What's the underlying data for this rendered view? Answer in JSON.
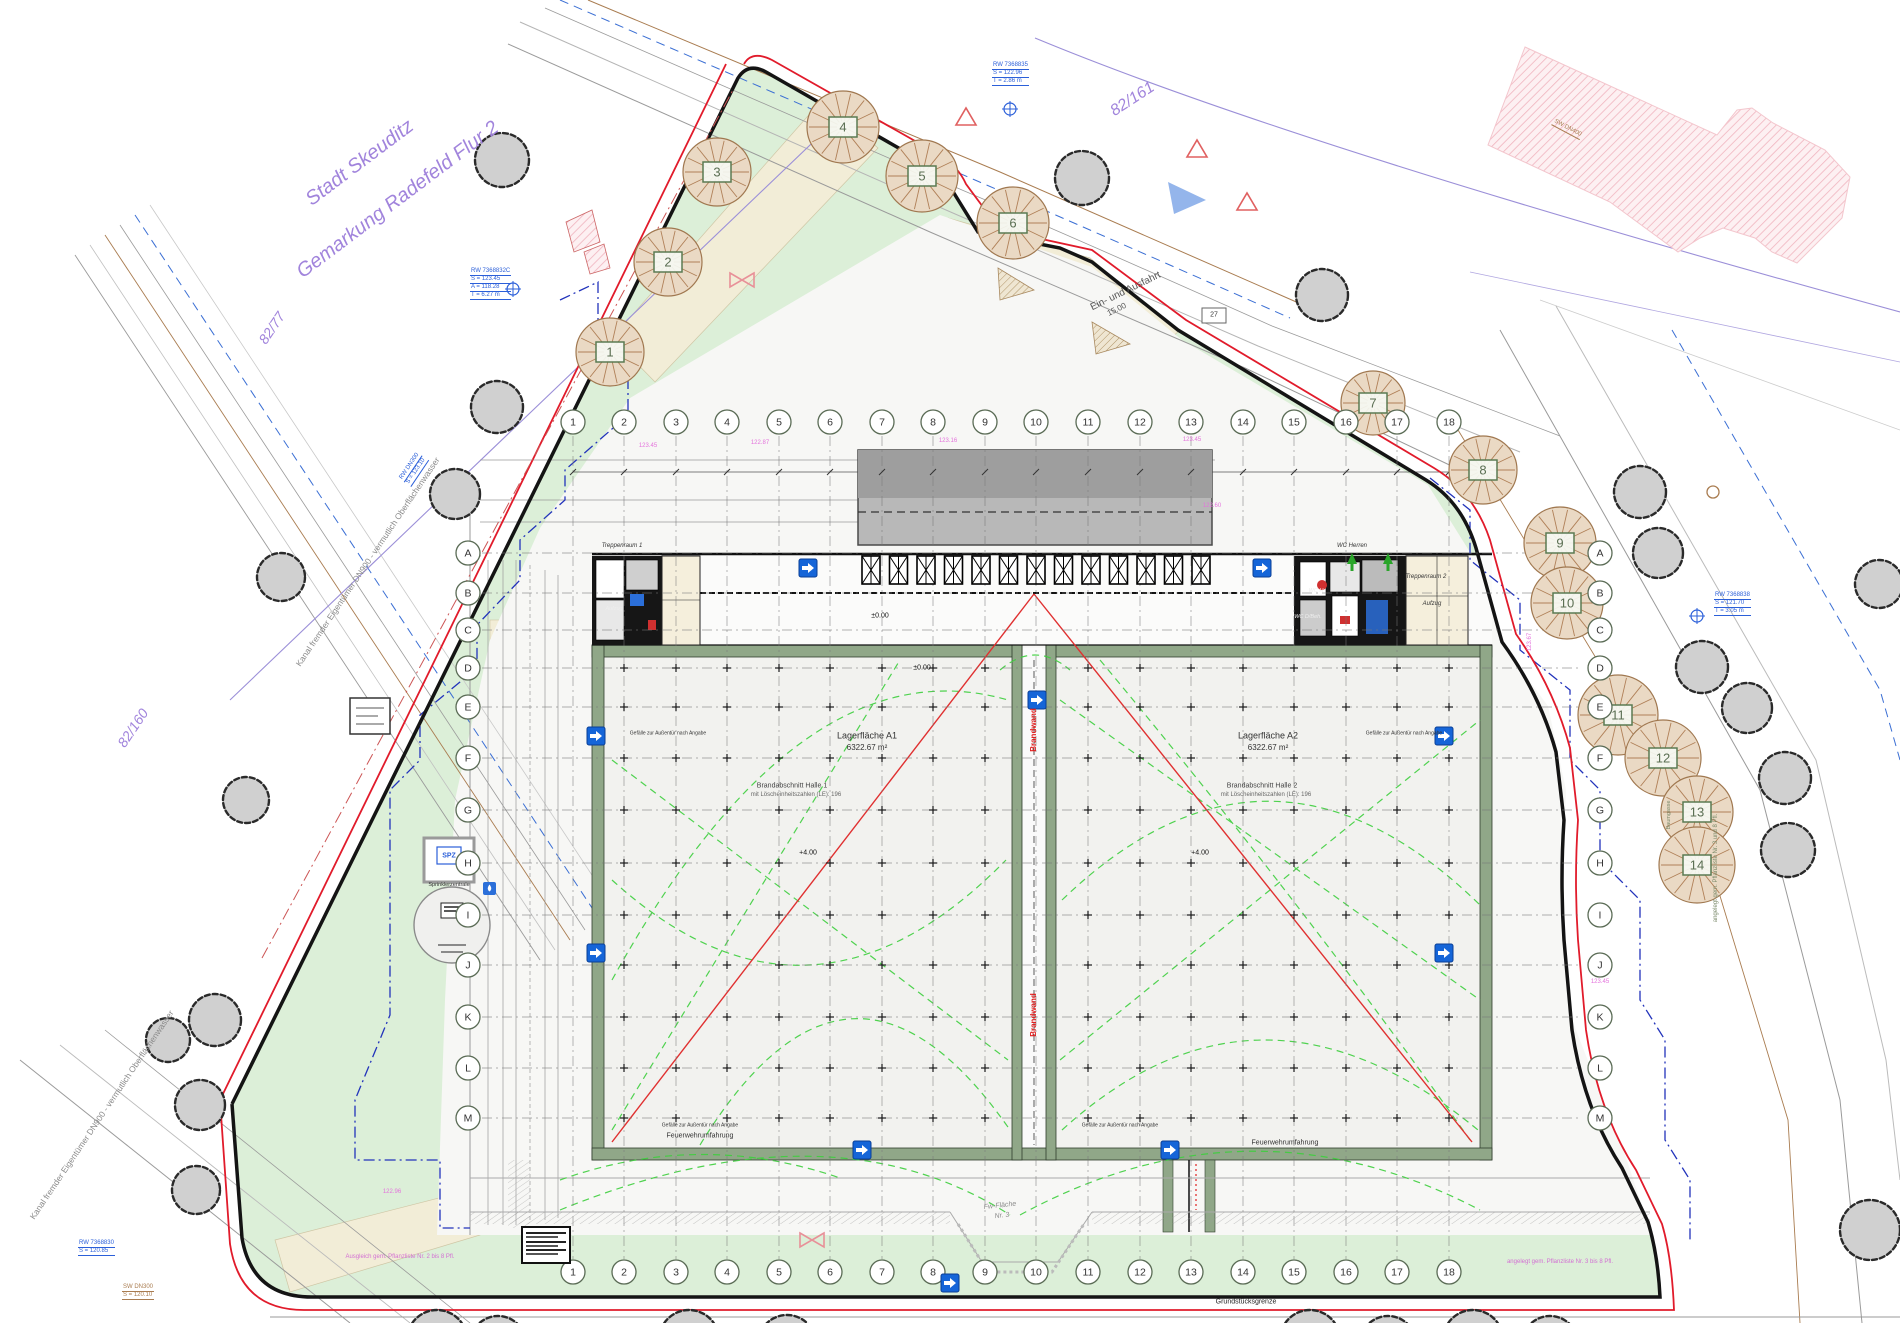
{
  "drawing": {
    "title_note": "Lageplan / Grundriss Logistikhalle",
    "colors": {
      "site_green": "#dcefd8",
      "pavement": "#f7f7f5",
      "beige": "#f2edd7",
      "wall_olive": "#90a788",
      "boundary_black": "#141414",
      "boundary_red": "#e11b2b",
      "fire_green": "#3ecf3e",
      "setback_blue": "#2233bb",
      "cadastral_purple": "#a184dc",
      "utility_brown": "#a97c50",
      "elevation_pink": "#e473dc",
      "icon_blue": "#1565d8",
      "canopy_gray": "#b8b8b8",
      "tree_existing": "#d0d0d0",
      "tree_planted": "#ead9c4"
    },
    "grid": {
      "numbers": [
        "1",
        "2",
        "3",
        "4",
        "5",
        "6",
        "7",
        "8",
        "9",
        "10",
        "11",
        "12",
        "13",
        "14",
        "15",
        "16",
        "17",
        "18"
      ],
      "letters": [
        "A",
        "B",
        "C",
        "D",
        "E",
        "F",
        "G",
        "H",
        "I",
        "J",
        "K",
        "L",
        "M"
      ],
      "xs": [
        573,
        624,
        676,
        727,
        779,
        830,
        882,
        933,
        985,
        1036,
        1088,
        1140,
        1191,
        1243,
        1294,
        1346,
        1397,
        1449
      ],
      "ys": [
        553,
        593,
        630,
        668,
        707,
        758,
        810,
        863,
        915,
        965,
        1017,
        1068,
        1118
      ],
      "top_y": 422,
      "bottom_y": 1272,
      "left_x": 468,
      "right_x": 1600,
      "line_top": 436,
      "line_bottom": 1259,
      "line_left": 482,
      "line_right": 1578
    },
    "halls": {
      "xs1": [
        624,
        676,
        727,
        779,
        830,
        882,
        933,
        985
      ],
      "xs2": [
        1088,
        1140,
        1191,
        1243,
        1294,
        1346,
        1397,
        1449
      ],
      "ys": [
        668,
        707,
        758,
        810,
        863,
        915,
        965,
        1017,
        1068,
        1118
      ]
    },
    "docks": {
      "count": 13,
      "x0": 862,
      "step": 27.5,
      "w": 18,
      "y": 556,
      "h": 28
    },
    "trees": {
      "planted": [
        {
          "n": "1",
          "x": 610,
          "y": 352,
          "r": 34
        },
        {
          "n": "2",
          "x": 668,
          "y": 262,
          "r": 34
        },
        {
          "n": "3",
          "x": 717,
          "y": 172,
          "r": 34
        },
        {
          "n": "4",
          "x": 843,
          "y": 127,
          "r": 36
        },
        {
          "n": "5",
          "x": 922,
          "y": 176,
          "r": 36
        },
        {
          "n": "6",
          "x": 1013,
          "y": 223,
          "r": 36
        },
        {
          "n": "7",
          "x": 1373,
          "y": 403,
          "r": 32
        },
        {
          "n": "8",
          "x": 1483,
          "y": 470,
          "r": 34
        },
        {
          "n": "9",
          "x": 1560,
          "y": 543,
          "r": 36
        },
        {
          "n": "10",
          "x": 1567,
          "y": 603,
          "r": 36
        },
        {
          "n": "11",
          "x": 1618,
          "y": 715,
          "r": 40
        },
        {
          "n": "12",
          "x": 1663,
          "y": 758,
          "r": 38
        },
        {
          "n": "13",
          "x": 1697,
          "y": 812,
          "r": 36
        },
        {
          "n": "14",
          "x": 1697,
          "y": 865,
          "r": 38
        }
      ],
      "existing": [
        {
          "x": 502,
          "y": 160,
          "r": 27
        },
        {
          "x": 497,
          "y": 407,
          "r": 26
        },
        {
          "x": 455,
          "y": 494,
          "r": 25
        },
        {
          "x": 281,
          "y": 577,
          "r": 24
        },
        {
          "x": 246,
          "y": 800,
          "r": 23
        },
        {
          "x": 215,
          "y": 1020,
          "r": 26
        },
        {
          "x": 200,
          "y": 1105,
          "r": 25
        },
        {
          "x": 196,
          "y": 1190,
          "r": 24
        },
        {
          "x": 168,
          "y": 1040,
          "r": 22
        },
        {
          "x": 1082,
          "y": 178,
          "r": 27
        },
        {
          "x": 1322,
          "y": 295,
          "r": 26
        },
        {
          "x": 1640,
          "y": 492,
          "r": 26
        },
        {
          "x": 1658,
          "y": 553,
          "r": 25
        },
        {
          "x": 1702,
          "y": 667,
          "r": 26
        },
        {
          "x": 1747,
          "y": 708,
          "r": 25
        },
        {
          "x": 1785,
          "y": 778,
          "r": 26
        },
        {
          "x": 1788,
          "y": 850,
          "r": 27
        },
        {
          "x": 1879,
          "y": 584,
          "r": 24
        },
        {
          "x": 1870,
          "y": 1230,
          "r": 30
        },
        {
          "x": 437,
          "y": 1340,
          "r": 30
        },
        {
          "x": 498,
          "y": 1344,
          "r": 28
        },
        {
          "x": 689,
          "y": 1340,
          "r": 30
        },
        {
          "x": 787,
          "y": 1344,
          "r": 29
        },
        {
          "x": 1310,
          "y": 1340,
          "r": 30
        },
        {
          "x": 1388,
          "y": 1344,
          "r": 28
        },
        {
          "x": 1473,
          "y": 1340,
          "r": 30
        },
        {
          "x": 1550,
          "y": 1344,
          "r": 28
        }
      ]
    },
    "icons": {
      "doors": [
        [
          808,
          568
        ],
        [
          1262,
          568
        ],
        [
          596,
          736
        ],
        [
          1444,
          736
        ],
        [
          596,
          953
        ],
        [
          1444,
          953
        ],
        [
          862,
          1150
        ],
        [
          1170,
          1150
        ],
        [
          950,
          1283
        ],
        [
          1037,
          700
        ]
      ],
      "manholes_blue": [
        [
          513,
          289
        ],
        [
          1010,
          109
        ],
        [
          1697,
          616
        ]
      ],
      "manholes_brown": [
        [
          1713,
          492
        ]
      ],
      "green_arrows": [
        [
          1352,
          562
        ],
        [
          1388,
          562
        ]
      ],
      "bowties": [
        [
          742,
          280
        ],
        [
          812,
          1240
        ]
      ],
      "warn_triangles": [
        [
          966,
          118
        ],
        [
          1197,
          150
        ],
        [
          1247,
          203
        ]
      ]
    },
    "annotations": [
      {
        "t": "Stadt Skeuditz",
        "x": 360,
        "y": 163,
        "rot": -37,
        "fs": 20,
        "c": "#a184dc",
        "i": 1
      },
      {
        "t": "Gemarkung Radefeld Flur 2",
        "x": 398,
        "y": 200,
        "rot": -37,
        "fs": 20,
        "c": "#a184dc",
        "i": 1
      },
      {
        "t": "82/161",
        "x": 1133,
        "y": 100,
        "rot": -33,
        "fs": 16,
        "c": "#a184dc",
        "i": 1
      },
      {
        "t": "82/77",
        "x": 272,
        "y": 328,
        "rot": -56,
        "fs": 14,
        "c": "#a184dc",
        "i": 1
      },
      {
        "t": "82/160",
        "x": 133,
        "y": 728,
        "rot": -56,
        "fs": 14,
        "c": "#a184dc",
        "i": 1
      },
      {
        "t": "Kanal fremder Eigentümer DN900 - vermutlich Oberflächenwasser",
        "x": 368,
        "y": 562,
        "rot": -56,
        "fs": 8.5,
        "c": "#8a8a8a"
      },
      {
        "t": "Kanal fremder Eigentümer DN900 - vermutlich Oberflächenwasser",
        "x": 102,
        "y": 1115,
        "rot": -56,
        "fs": 8.5,
        "c": "#8a8a8a"
      },
      {
        "t": "Ein- und Ausfahrt",
        "x": 1126,
        "y": 292,
        "rot": -26,
        "fs": 10,
        "c": "#555"
      },
      {
        "t": "15.00",
        "x": 1117,
        "y": 310,
        "rot": -26,
        "fs": 8,
        "c": "#555"
      },
      {
        "t": "Lagerfläche A1",
        "x": 867,
        "y": 736,
        "fs": 9,
        "c": "#333"
      },
      {
        "t": "6322.67 m²",
        "x": 867,
        "y": 748,
        "fs": 8,
        "c": "#333"
      },
      {
        "t": "Lagerfläche A2",
        "x": 1268,
        "y": 736,
        "fs": 9,
        "c": "#333"
      },
      {
        "t": "6322.67 m²",
        "x": 1268,
        "y": 748,
        "fs": 8,
        "c": "#333"
      },
      {
        "t": "Brandabschnitt Halle 1",
        "x": 792,
        "y": 786,
        "fs": 7,
        "c": "#444"
      },
      {
        "t": "mit Löscheinheitszahlen (LE): 196",
        "x": 796,
        "y": 795,
        "fs": 6,
        "c": "#666"
      },
      {
        "t": "Brandabschnitt Halle 2",
        "x": 1262,
        "y": 786,
        "fs": 7,
        "c": "#444"
      },
      {
        "t": "mit Löscheinheitszahlen (LE): 196",
        "x": 1266,
        "y": 795,
        "fs": 6,
        "c": "#666"
      },
      {
        "t": "Brandwand",
        "x": 1034,
        "y": 730,
        "rot": -90,
        "fs": 8,
        "c": "#e02020",
        "b": 1
      },
      {
        "t": "Brandwand",
        "x": 1034,
        "y": 1015,
        "rot": -90,
        "fs": 8,
        "c": "#e02020",
        "b": 1
      },
      {
        "t": "WC Herren",
        "x": 1352,
        "y": 546,
        "fs": 6,
        "c": "#333",
        "i": 1
      },
      {
        "t": "Treppenraum 2",
        "x": 1426,
        "y": 577,
        "fs": 6,
        "c": "#333",
        "i": 1
      },
      {
        "t": "Aufzug",
        "x": 1432,
        "y": 604,
        "fs": 6,
        "c": "#333",
        "i": 1
      },
      {
        "t": "WC H",
        "x": 1316,
        "y": 592,
        "fs": 5.5,
        "c": "#eee",
        "i": 1
      },
      {
        "t": "WC D/Beh.",
        "x": 1308,
        "y": 618,
        "fs": 5.5,
        "c": "#eee",
        "i": 1
      },
      {
        "t": "Treppenraum 1",
        "x": 622,
        "y": 546,
        "fs": 6,
        "c": "#333",
        "i": 1
      },
      {
        "t": "Aufzug",
        "x": 614,
        "y": 610,
        "fs": 5.5,
        "c": "#eee",
        "i": 1
      },
      {
        "t": "Feuerwehrumfahrung",
        "x": 700,
        "y": 1136,
        "fs": 7,
        "c": "#333"
      },
      {
        "t": "Feuerwehrumfahrung",
        "x": 1285,
        "y": 1143,
        "fs": 7,
        "c": "#333"
      },
      {
        "t": "Fw-Fläche",
        "x": 1000,
        "y": 1206,
        "rot": -6,
        "fs": 7,
        "c": "#8a8a8a",
        "i": 1
      },
      {
        "t": "Nr. 3",
        "x": 1002,
        "y": 1216,
        "rot": -6,
        "fs": 7,
        "c": "#8a8a8a",
        "i": 1
      },
      {
        "t": "Grundstücksgrenze",
        "x": 1246,
        "y": 1302,
        "fs": 7,
        "c": "#222"
      },
      {
        "t": "SPZ",
        "x": 449,
        "y": 856,
        "fs": 7,
        "c": "#2b5fd9",
        "b": 1
      },
      {
        "t": "Sprinklerzentrale",
        "x": 449,
        "y": 886,
        "fs": 5.5,
        "c": "#333"
      },
      {
        "t": "angelegt gem. Pflanzliste Nr. 3 und 8 Pfl.",
        "x": 1716,
        "y": 868,
        "rot": -90,
        "fs": 6,
        "c": "#7a8a6a"
      },
      {
        "t": "Baumgasse",
        "x": 1670,
        "y": 815,
        "rot": -90,
        "fs": 5.5,
        "c": "#7a8a6a"
      },
      {
        "t": "Ausgleich gem. Pflanzliste Nr. 2 bis 8 Pfl.",
        "x": 400,
        "y": 1257,
        "fs": 6,
        "c": "#d36fd3"
      },
      {
        "t": "angelegt gem. Pflanzliste Nr. 3 bis 8 Pfl.",
        "x": 1560,
        "y": 1262,
        "fs": 6,
        "c": "#d36fd3"
      },
      {
        "t": "±0.00",
        "x": 880,
        "y": 616,
        "fs": 7,
        "c": "#111"
      },
      {
        "t": "±0.00",
        "x": 922,
        "y": 668,
        "fs": 7,
        "c": "#111"
      },
      {
        "t": "+4.00",
        "x": 808,
        "y": 853,
        "fs": 7,
        "c": "#111"
      },
      {
        "t": "+4.00",
        "x": 1200,
        "y": 853,
        "fs": 7,
        "c": "#111"
      },
      {
        "t": "27",
        "x": 1214,
        "y": 315,
        "fs": 7,
        "c": "#333"
      },
      {
        "t": "Gefälle zur Außentür nach Angabe",
        "x": 668,
        "y": 734,
        "fs": 5,
        "c": "#333"
      },
      {
        "t": "Gefälle zur Außentür nach Angabe",
        "x": 1404,
        "y": 734,
        "fs": 5,
        "c": "#333"
      },
      {
        "t": "Gefälle zur Außentür nach Angabe",
        "x": 700,
        "y": 1126,
        "fs": 5,
        "c": "#333"
      },
      {
        "t": "Gefälle zur Außentür nach Angabe",
        "x": 1120,
        "y": 1126,
        "fs": 5,
        "c": "#333"
      },
      {
        "t": "123.45",
        "x": 648,
        "y": 446,
        "fs": 6,
        "c": "#e473dc"
      },
      {
        "t": "122.87",
        "x": 760,
        "y": 443,
        "fs": 6,
        "c": "#e473dc"
      },
      {
        "t": "123.16",
        "x": 948,
        "y": 441,
        "fs": 6,
        "c": "#e473dc"
      },
      {
        "t": "123.45",
        "x": 1192,
        "y": 440,
        "fs": 6,
        "c": "#e473dc"
      },
      {
        "t": "122.60",
        "x": 1212,
        "y": 506,
        "fs": 6,
        "c": "#e473dc"
      },
      {
        "t": "123.67",
        "x": 1530,
        "y": 642,
        "rot": -90,
        "fs": 6,
        "c": "#e473dc"
      },
      {
        "t": "123.45",
        "x": 1600,
        "y": 982,
        "fs": 6,
        "c": "#e473dc"
      },
      {
        "t": "122.96",
        "x": 392,
        "y": 1192,
        "fs": 6,
        "c": "#e473dc"
      }
    ],
    "utility_blocks": [
      {
        "x": 470,
        "y": 268,
        "rot": 0,
        "c": "#2b5fd9",
        "lines": [
          "RW 7368832C",
          "S = 123.45",
          "A = 118.28",
          "T = 6.27 m"
        ]
      },
      {
        "x": 992,
        "y": 62,
        "rot": 0,
        "c": "#2b5fd9",
        "lines": [
          "RW 7368835",
          "S = 122.96",
          "T = 2.86 m"
        ]
      },
      {
        "x": 1714,
        "y": 592,
        "rot": 0,
        "c": "#2b5fd9",
        "lines": [
          "RW 7368838",
          "S = 121.70",
          "T = 3.05 m"
        ]
      },
      {
        "x": 398,
        "y": 478,
        "rot": -56,
        "c": "#2b5fd9",
        "lines": [
          "RW DN300",
          "S = 123.10"
        ]
      },
      {
        "x": 78,
        "y": 1240,
        "rot": 0,
        "c": "#2b5fd9",
        "lines": [
          "RW 7368830",
          "S = 120.85"
        ]
      },
      {
        "x": 122,
        "y": 1284,
        "rot": 0,
        "c": "#a97c50",
        "lines": [
          "SW DN300",
          "S = 120.10"
        ]
      },
      {
        "x": 1555,
        "y": 118,
        "rot": 28,
        "c": "#a97c50",
        "lines": [
          "SW DN400"
        ]
      }
    ]
  }
}
